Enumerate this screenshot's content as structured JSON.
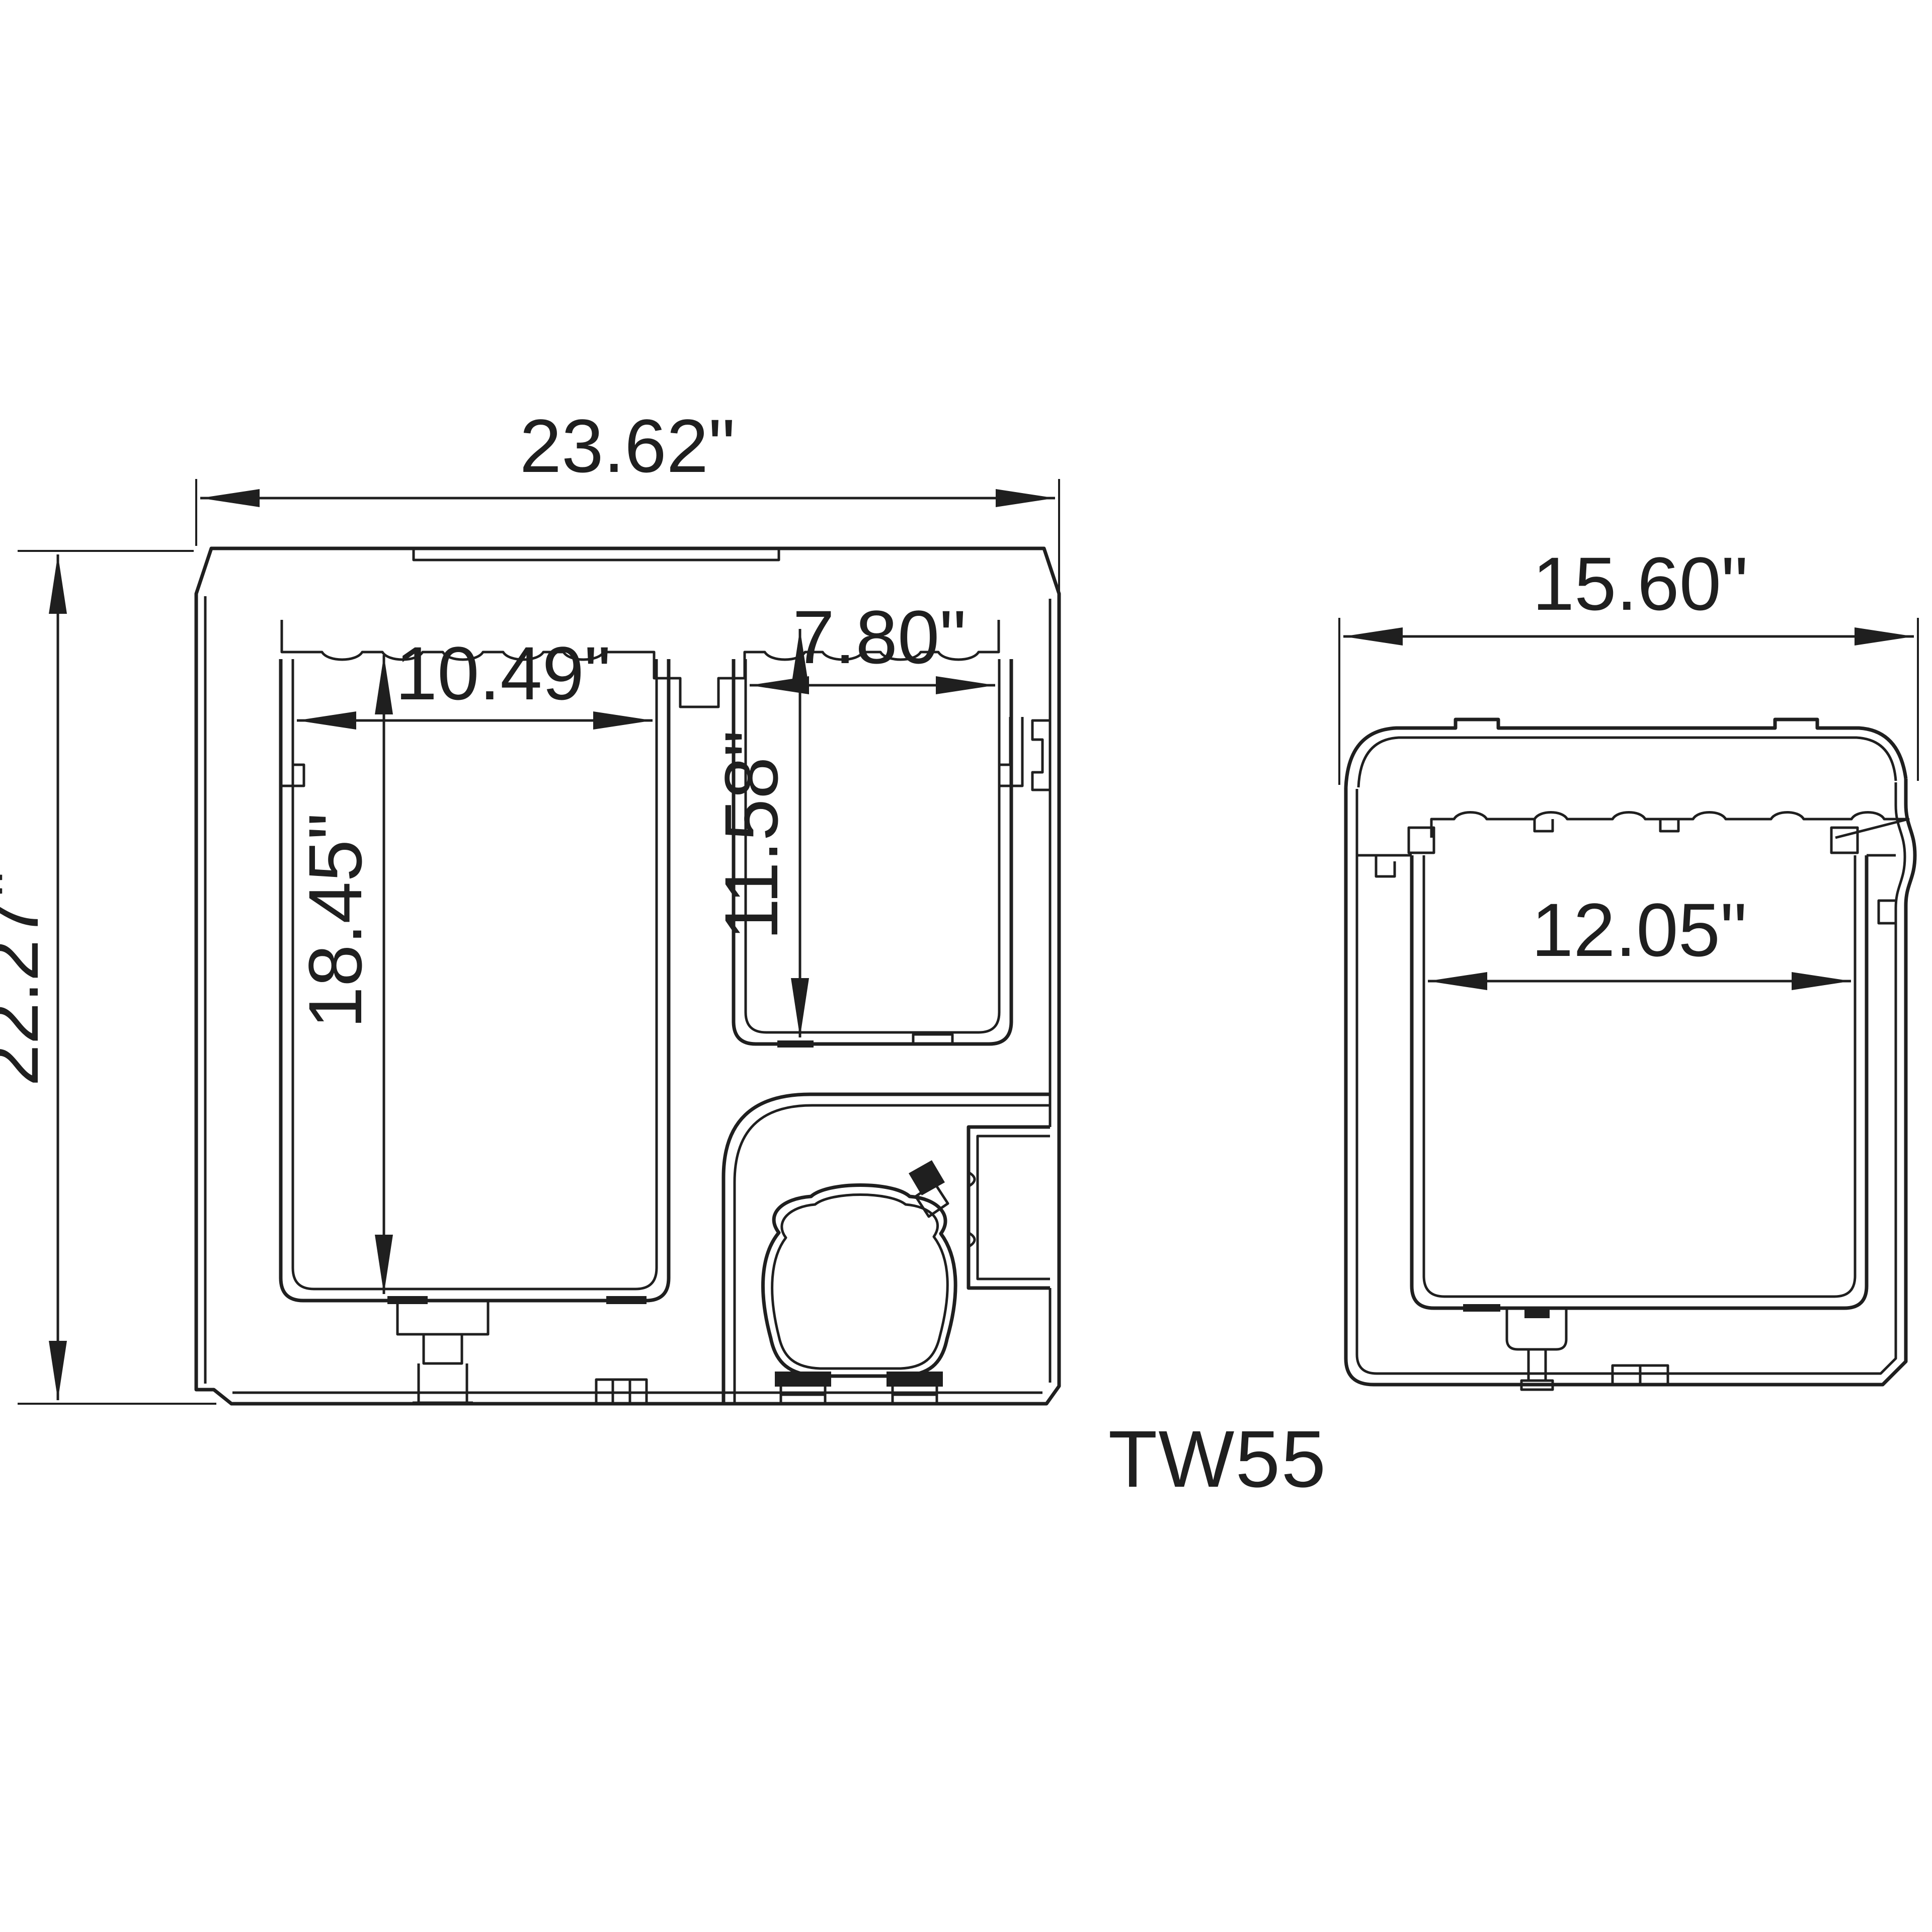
{
  "model": "TW55",
  "views": {
    "front": {
      "name": "front cross-section",
      "overall_width": "23.62\"",
      "overall_height": "22.27\"",
      "left_compartment_width": "10.49\"",
      "right_compartment_width": "7.80\"",
      "left_compartment_depth": "18.45\"",
      "right_compartment_depth": "11.58\""
    },
    "side": {
      "name": "side cross-section",
      "overall_depth": "15.60\"",
      "inner_depth": "12.05\""
    }
  },
  "colors": {
    "line": "#1f1f1f",
    "background": "#ffffff"
  }
}
